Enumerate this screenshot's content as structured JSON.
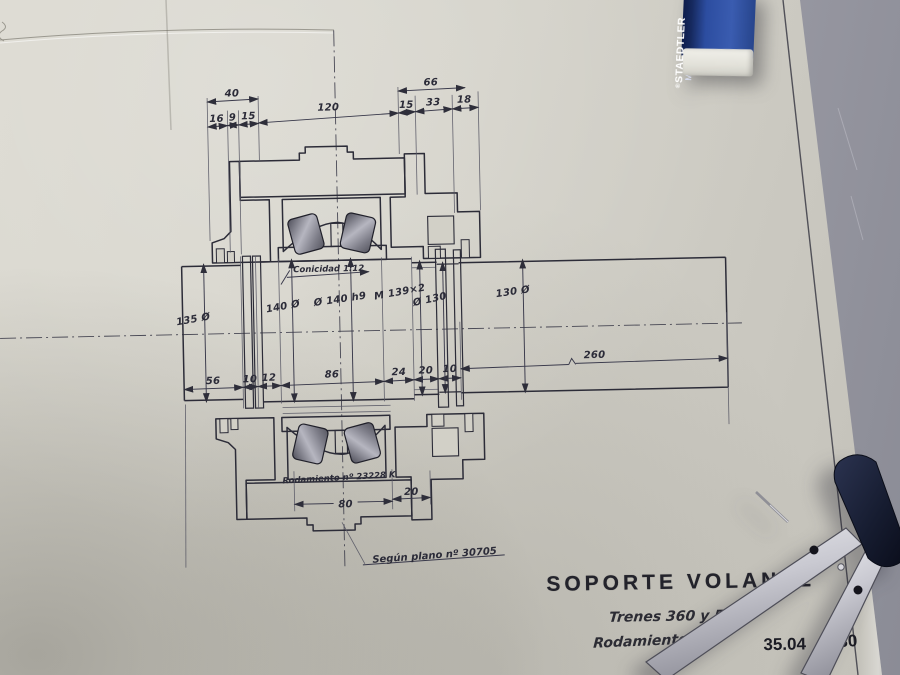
{
  "photo": {
    "paper_color": "#d3d1c8",
    "desk_color": "#90929c",
    "ink_color": "#2c2c38",
    "hatch_color": "#444450",
    "roller_color": "#6a6a76",
    "eraser_blue": "#2c4da0",
    "eraser_navy": "#13255c",
    "compass_navy": "#1a2136",
    "compass_silver": "#d0d0d8"
  },
  "drawing": {
    "dims_top_row1": [
      "40",
      "66"
    ],
    "dims_top_row2": [
      "16",
      "9",
      "15",
      "120",
      "15",
      "33",
      "18"
    ],
    "dims_diameters": [
      "135 Ø",
      "140 Ø",
      "Ø 140 h9",
      "M 139×2",
      "Ø 130",
      "130 Ø"
    ],
    "dims_bottom_chain": [
      "56",
      "10",
      "12",
      "86",
      "24",
      "20",
      "10"
    ],
    "dim_length": "260",
    "dims_bearing": [
      "80",
      "20"
    ],
    "note_taper": "Conicidad  1:12",
    "note_bearing": "Rodamiento nº 23228 K",
    "note_plan": "Según plano nº 30705"
  },
  "title_block": {
    "title": "SOPORTE VOLANTE",
    "line1": "Trenes 360 y 550",
    "line2": "Rodamientos 23",
    "code_left": "35.04",
    "code_right": "30"
  },
  "eraser": {
    "mark": "®",
    "brand": "STAEDTLER",
    "model": "Mars pl"
  }
}
